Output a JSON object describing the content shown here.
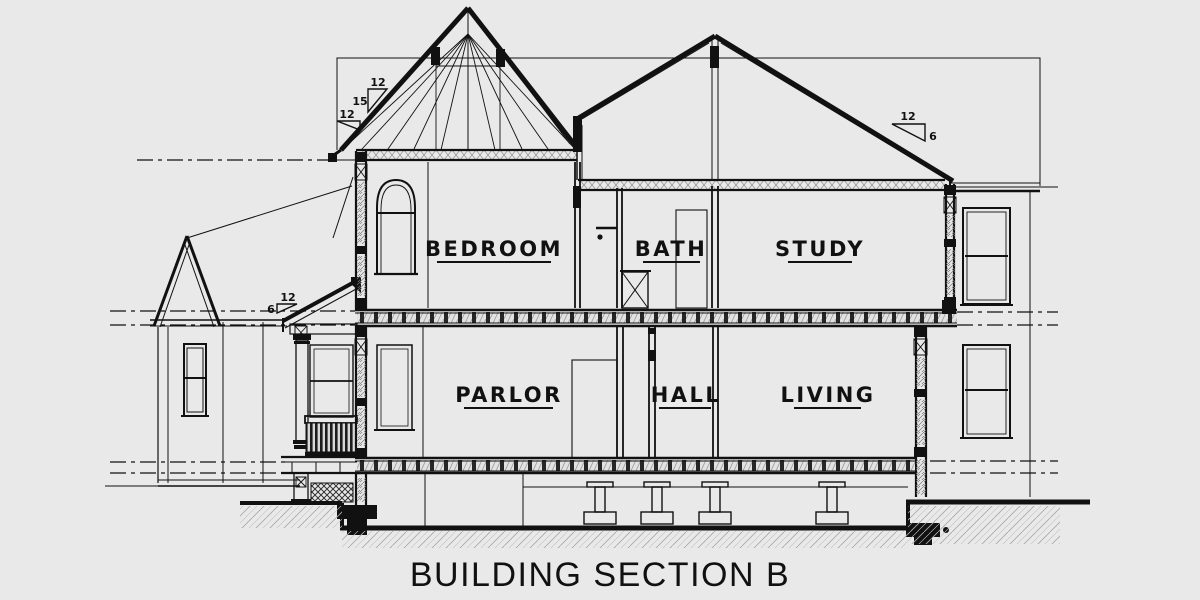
{
  "drawing": {
    "title": "BUILDING SECTION B",
    "background_color": "#e9e9e9",
    "ink_color": "#111111",
    "rooms": {
      "upper": [
        {
          "label": "BEDROOM"
        },
        {
          "label": "BATH"
        },
        {
          "label": "STUDY"
        }
      ],
      "lower": [
        {
          "label": "PARLOR"
        },
        {
          "label": "HALL"
        },
        {
          "label": "LIVING"
        }
      ]
    },
    "pitch_markers": {
      "turret": {
        "run": "12",
        "rise": "15"
      },
      "eave_flare": {
        "run": "12"
      },
      "main_right": {
        "run": "12",
        "rise": "6"
      },
      "porch": {
        "run": "12",
        "rise": "6"
      }
    }
  }
}
